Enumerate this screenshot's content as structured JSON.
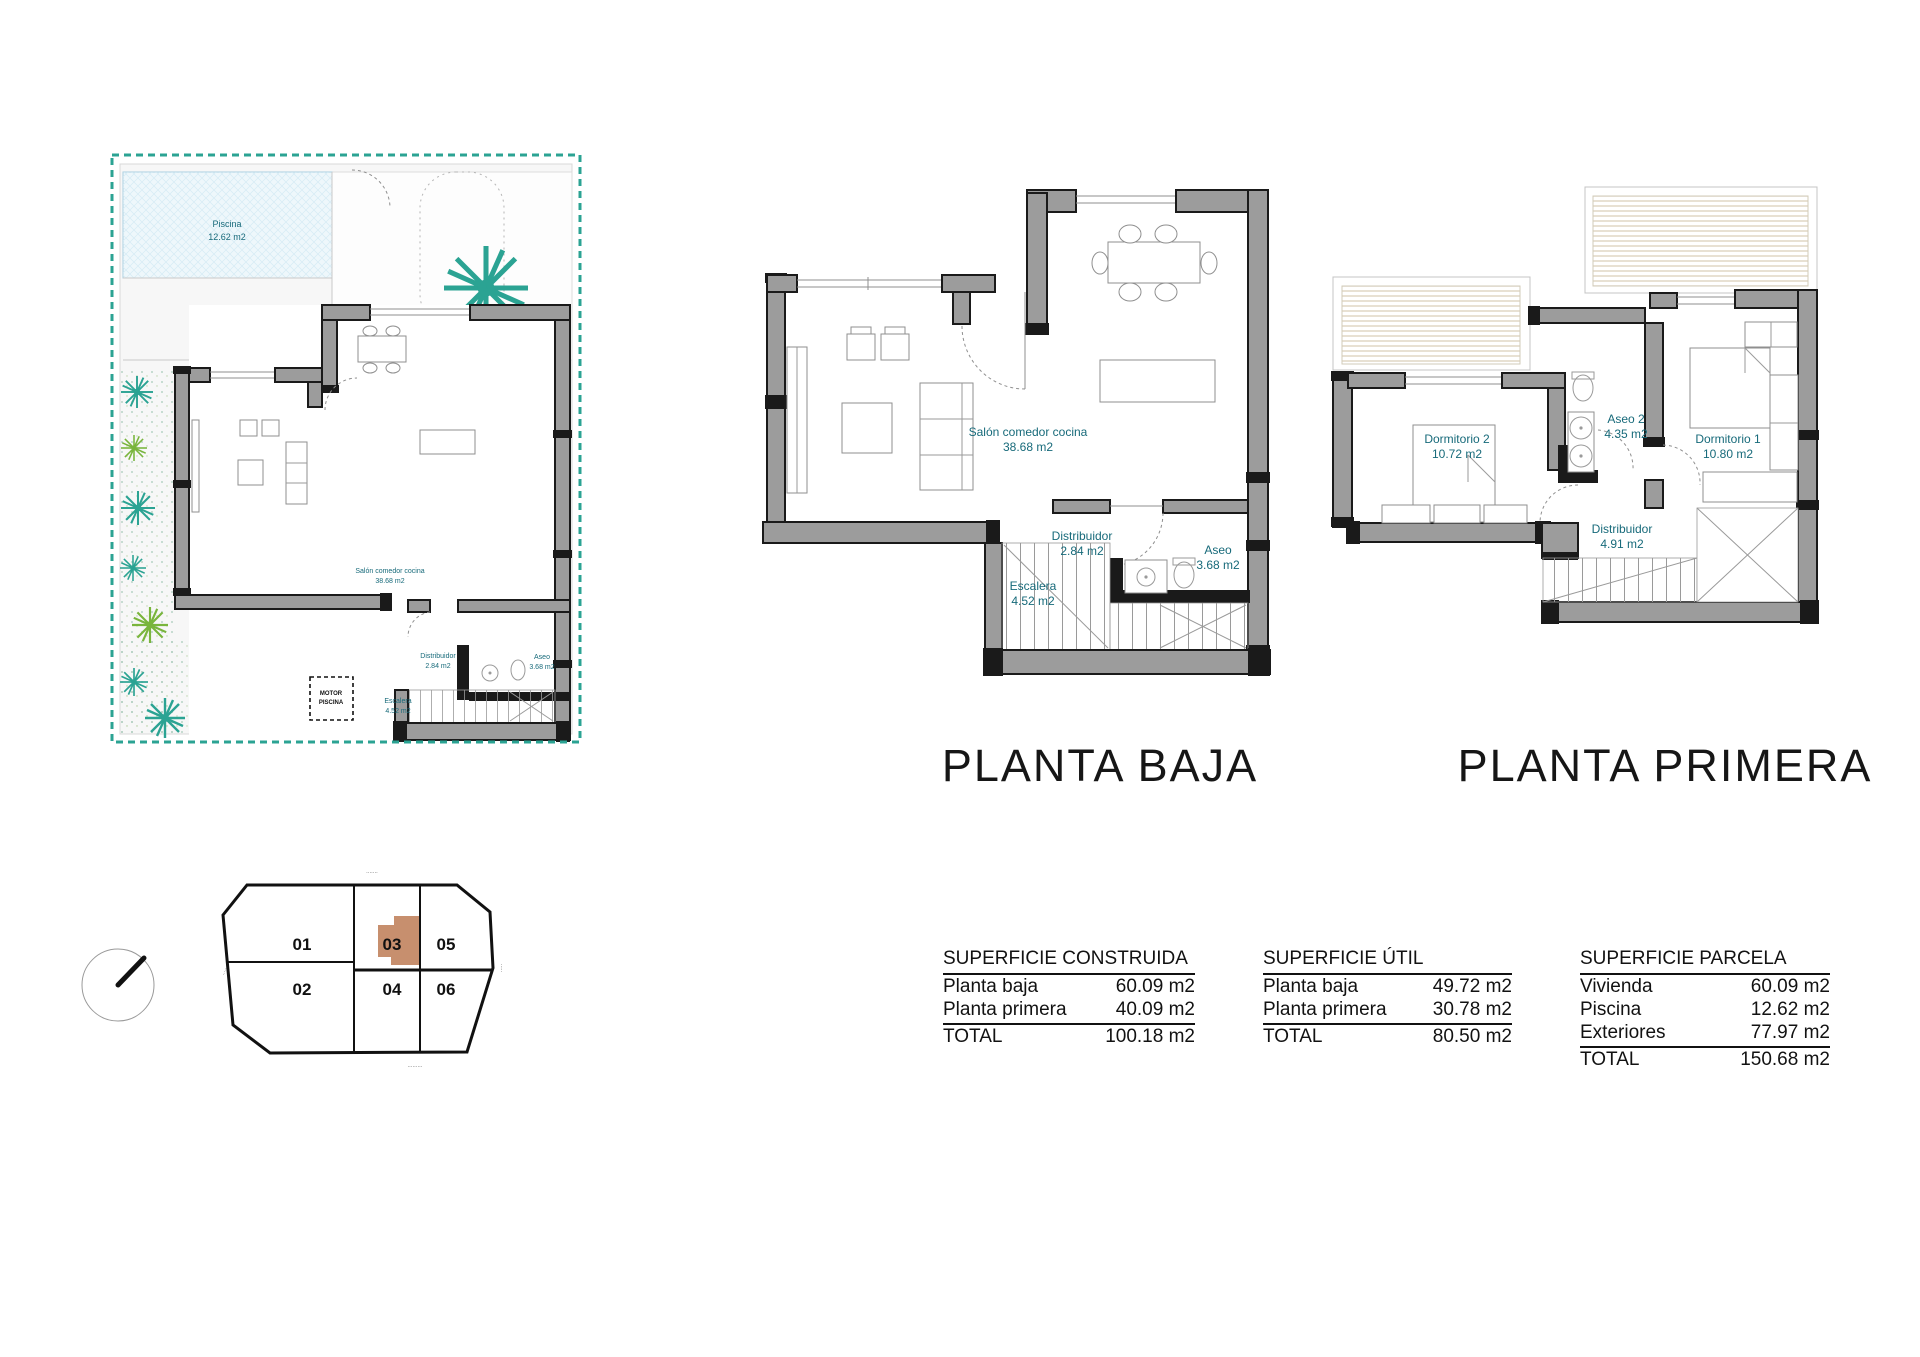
{
  "colors": {
    "label_teal": "#176a7a",
    "parcel_dash_teal": "#2ba393",
    "wall_gray": "#9c9c9c",
    "highlight_brown": "#c78f6e",
    "pool_blue": "#eef7fb"
  },
  "site_plan": {
    "pool_name": "Piscina",
    "pool_area": "12.62 m2",
    "motor_line1": "MOTOR",
    "motor_line2": "PISCINA",
    "rooms": [
      {
        "name": "Salón comedor cocina",
        "area": "38.68 m2"
      },
      {
        "name": "Distribuidor",
        "area": "2.84 m2"
      },
      {
        "name": "Aseo",
        "area": "3.68 m2"
      },
      {
        "name": "Escalera",
        "area": "4.52 m2"
      }
    ]
  },
  "planta_baja": {
    "title": "PLANTA BAJA",
    "rooms": [
      {
        "name": "Salón comedor cocina",
        "area": "38.68 m2"
      },
      {
        "name": "Distribuidor",
        "area": "2.84 m2"
      },
      {
        "name": "Aseo",
        "area": "3.68 m2"
      },
      {
        "name": "Escalera",
        "area": "4.52 m2"
      }
    ]
  },
  "planta_primera": {
    "title": "PLANTA PRIMERA",
    "rooms": [
      {
        "name": "Dormitorio 2",
        "area": "10.72 m2"
      },
      {
        "name": "Aseo 2",
        "area": "4.35 m2"
      },
      {
        "name": "Dormitorio 1",
        "area": "10.80 m2"
      },
      {
        "name": "Distribuidor",
        "area": "4.91 m2"
      }
    ]
  },
  "plot": {
    "units": [
      "01",
      "02",
      "03",
      "04",
      "05",
      "06"
    ],
    "highlighted_unit": "03",
    "street_label_top": "·······",
    "street_label_bottom": "·········",
    "street_label_left": "·····",
    "street_label_right": "·····"
  },
  "tables": [
    {
      "title": "SUPERFICIE CONSTRUIDA",
      "rows": [
        {
          "label": "Planta baja",
          "value": "60.09 m2"
        },
        {
          "label": "Planta primera",
          "value": "40.09 m2"
        }
      ],
      "total_label": "TOTAL",
      "total_value": "100.18 m2"
    },
    {
      "title": "SUPERFICIE ÚTIL",
      "rows": [
        {
          "label": "Planta baja",
          "value": "49.72 m2"
        },
        {
          "label": "Planta primera",
          "value": "30.78 m2"
        }
      ],
      "total_label": "TOTAL",
      "total_value": "80.50 m2"
    },
    {
      "title": "SUPERFICIE PARCELA",
      "rows": [
        {
          "label": "Vivienda",
          "value": "60.09 m2"
        },
        {
          "label": "Piscina",
          "value": "12.62 m2"
        },
        {
          "label": "Exteriores",
          "value": "77.97 m2"
        }
      ],
      "total_label": "TOTAL",
      "total_value": "150.68 m2"
    }
  ]
}
